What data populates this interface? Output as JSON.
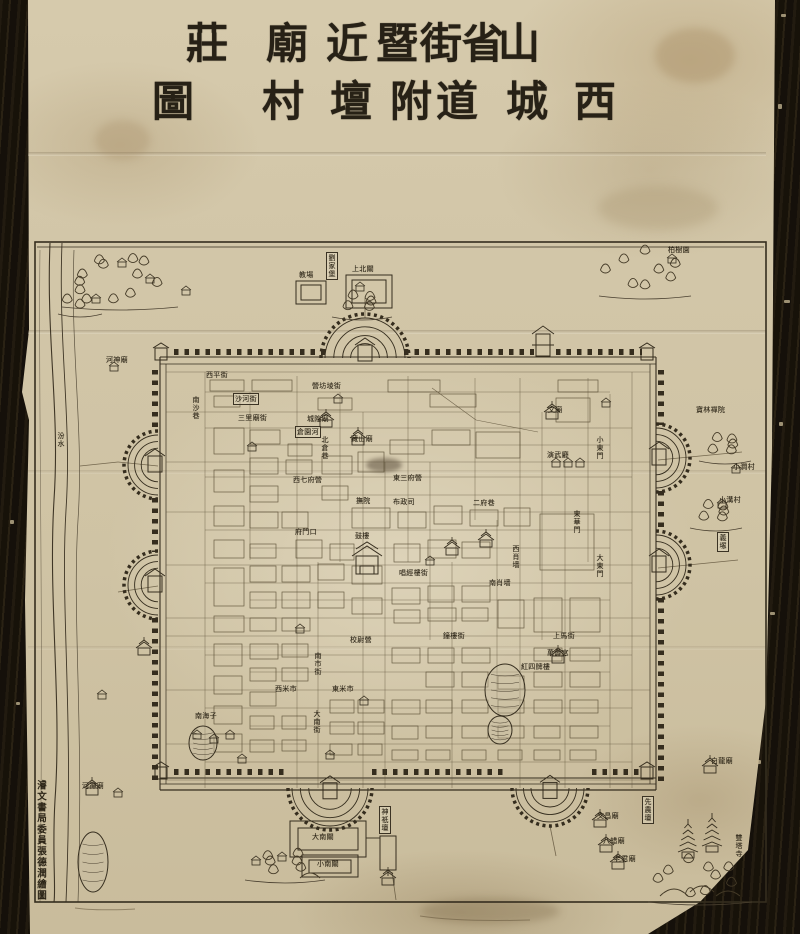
{
  "title": {
    "text": "山西省城街道暨附近壇廟村莊圖",
    "rows": [
      {
        "chars": [
          "莊",
          "廟",
          "近",
          "暨",
          "街",
          "省",
          "山"
        ]
      },
      {
        "chars": [
          "圖",
          "村",
          "壇",
          "附",
          "道",
          "城",
          "西"
        ]
      }
    ]
  },
  "colophon": {
    "text": "濬文書局委員張德潤繪圖"
  },
  "colors": {
    "paper": "#d2c6a8",
    "ink": "#2e2719",
    "line": "#4a4030",
    "wall": "#3a3224",
    "scroll": "#17120b"
  },
  "map_labels": [
    {
      "text": "教場",
      "x": 299,
      "y": 271,
      "o": "h"
    },
    {
      "text": "上北關",
      "x": 352,
      "y": 265,
      "o": "h"
    },
    {
      "text": "劉家堡",
      "x": 326,
      "y": 252,
      "o": "v",
      "box": true
    },
    {
      "text": "柏樹園",
      "x": 668,
      "y": 246,
      "o": "h"
    },
    {
      "text": "河神廟",
      "x": 106,
      "y": 356,
      "o": "h"
    },
    {
      "text": "汾水",
      "x": 57,
      "y": 432,
      "o": "v"
    },
    {
      "text": "寶林禪院",
      "x": 696,
      "y": 406,
      "o": "h"
    },
    {
      "text": "小澗村",
      "x": 733,
      "y": 463,
      "o": "h"
    },
    {
      "text": "小溝村",
      "x": 719,
      "y": 496,
      "o": "h"
    },
    {
      "text": "義塚",
      "x": 717,
      "y": 532,
      "o": "v",
      "box": true
    },
    {
      "text": "白龍廟",
      "x": 711,
      "y": 757,
      "o": "h"
    },
    {
      "text": "文昌廟",
      "x": 597,
      "y": 812,
      "o": "h"
    },
    {
      "text": "八蜡廟",
      "x": 603,
      "y": 837,
      "o": "h"
    },
    {
      "text": "老君廟",
      "x": 614,
      "y": 855,
      "o": "h"
    },
    {
      "text": "雙塔寺",
      "x": 735,
      "y": 834,
      "o": "v"
    },
    {
      "text": "先農壇",
      "x": 642,
      "y": 796,
      "o": "v",
      "box": true
    },
    {
      "text": "神祇壇",
      "x": 379,
      "y": 806,
      "o": "v",
      "box": true
    },
    {
      "text": "大南關",
      "x": 312,
      "y": 833,
      "o": "h"
    },
    {
      "text": "小南關",
      "x": 317,
      "y": 860,
      "o": "h"
    },
    {
      "text": "河神廟",
      "x": 82,
      "y": 782,
      "o": "h"
    },
    {
      "text": "西平街",
      "x": 206,
      "y": 371,
      "o": "h"
    },
    {
      "text": "沙河街",
      "x": 233,
      "y": 393,
      "o": "h",
      "box": true
    },
    {
      "text": "南沙巷",
      "x": 192,
      "y": 396,
      "o": "v"
    },
    {
      "text": "三里廟街",
      "x": 238,
      "y": 414,
      "o": "h"
    },
    {
      "text": "營坊堎街",
      "x": 312,
      "y": 382,
      "o": "h"
    },
    {
      "text": "城隍廟",
      "x": 307,
      "y": 415,
      "o": "h"
    },
    {
      "text": "倉園河",
      "x": 295,
      "y": 426,
      "o": "h",
      "box": true
    },
    {
      "text": "北倉巷",
      "x": 321,
      "y": 436,
      "o": "v"
    },
    {
      "text": "藏山廟",
      "x": 351,
      "y": 435,
      "o": "h"
    },
    {
      "text": "西七府營",
      "x": 293,
      "y": 476,
      "o": "h"
    },
    {
      "text": "東三府營",
      "x": 393,
      "y": 474,
      "o": "h"
    },
    {
      "text": "撫院",
      "x": 356,
      "y": 497,
      "o": "h"
    },
    {
      "text": "布政司",
      "x": 393,
      "y": 498,
      "o": "h"
    },
    {
      "text": "二府巷",
      "x": 473,
      "y": 499,
      "o": "h"
    },
    {
      "text": "府門口",
      "x": 295,
      "y": 528,
      "o": "h"
    },
    {
      "text": "鼓樓",
      "x": 355,
      "y": 532,
      "o": "h"
    },
    {
      "text": "唱經樓街",
      "x": 399,
      "y": 569,
      "o": "h"
    },
    {
      "text": "西肖墙",
      "x": 512,
      "y": 545,
      "o": "v"
    },
    {
      "text": "南肖墙",
      "x": 489,
      "y": 579,
      "o": "h"
    },
    {
      "text": "鐘樓街",
      "x": 443,
      "y": 632,
      "o": "h"
    },
    {
      "text": "上馬街",
      "x": 553,
      "y": 632,
      "o": "h"
    },
    {
      "text": "校尉營",
      "x": 350,
      "y": 636,
      "o": "h"
    },
    {
      "text": "萬壽宮",
      "x": 547,
      "y": 649,
      "o": "h"
    },
    {
      "text": "紅四牌樓",
      "x": 521,
      "y": 663,
      "o": "h"
    },
    {
      "text": "南市街",
      "x": 314,
      "y": 652,
      "o": "v"
    },
    {
      "text": "西米市",
      "x": 275,
      "y": 685,
      "o": "h"
    },
    {
      "text": "東米市",
      "x": 332,
      "y": 685,
      "o": "h"
    },
    {
      "text": "大南街",
      "x": 313,
      "y": 710,
      "o": "v"
    },
    {
      "text": "南海子",
      "x": 195,
      "y": 712,
      "o": "h"
    },
    {
      "text": "文廟",
      "x": 548,
      "y": 406,
      "o": "h"
    },
    {
      "text": "演武廳",
      "x": 547,
      "y": 451,
      "o": "h"
    },
    {
      "text": "東華門",
      "x": 573,
      "y": 510,
      "o": "v"
    },
    {
      "text": "小東門",
      "x": 596,
      "y": 436,
      "o": "v"
    },
    {
      "text": "大東門",
      "x": 596,
      "y": 554,
      "o": "v"
    }
  ]
}
